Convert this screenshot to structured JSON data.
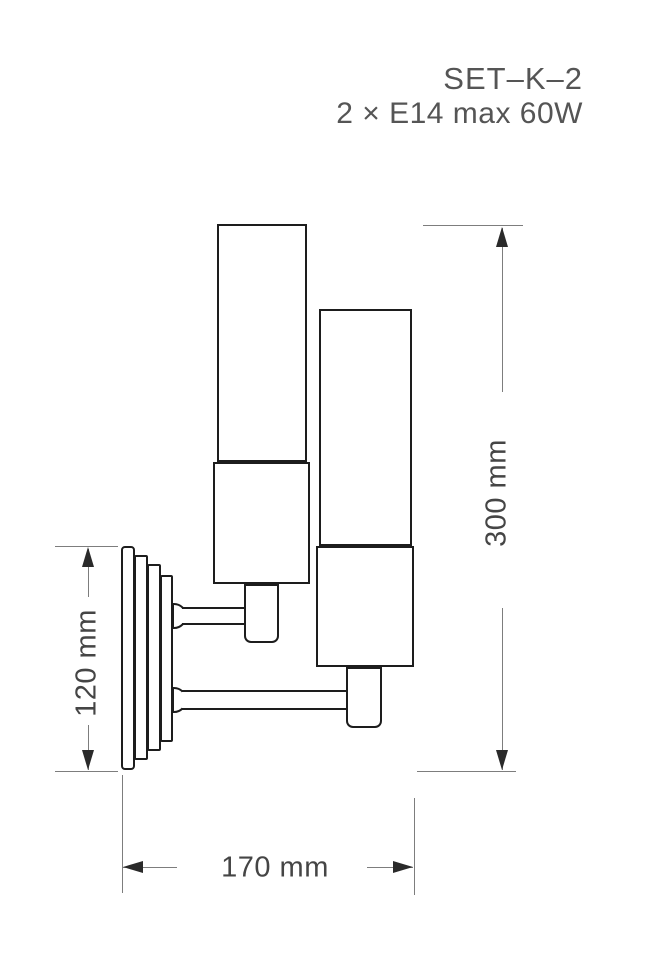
{
  "title": "SET–K–2",
  "subtitle": "2 × E14 max 60W",
  "dimensions": {
    "overall_height": "300 mm",
    "backplate_height": "120 mm",
    "projection_depth": "170 mm"
  },
  "colors": {
    "background": "#ffffff",
    "object_line": "#1d1d1d",
    "dimension_line": "#7d7d7d",
    "arrowhead": "#2a2a2a",
    "dimension_text": "#454545",
    "title_text": "#555555"
  }
}
